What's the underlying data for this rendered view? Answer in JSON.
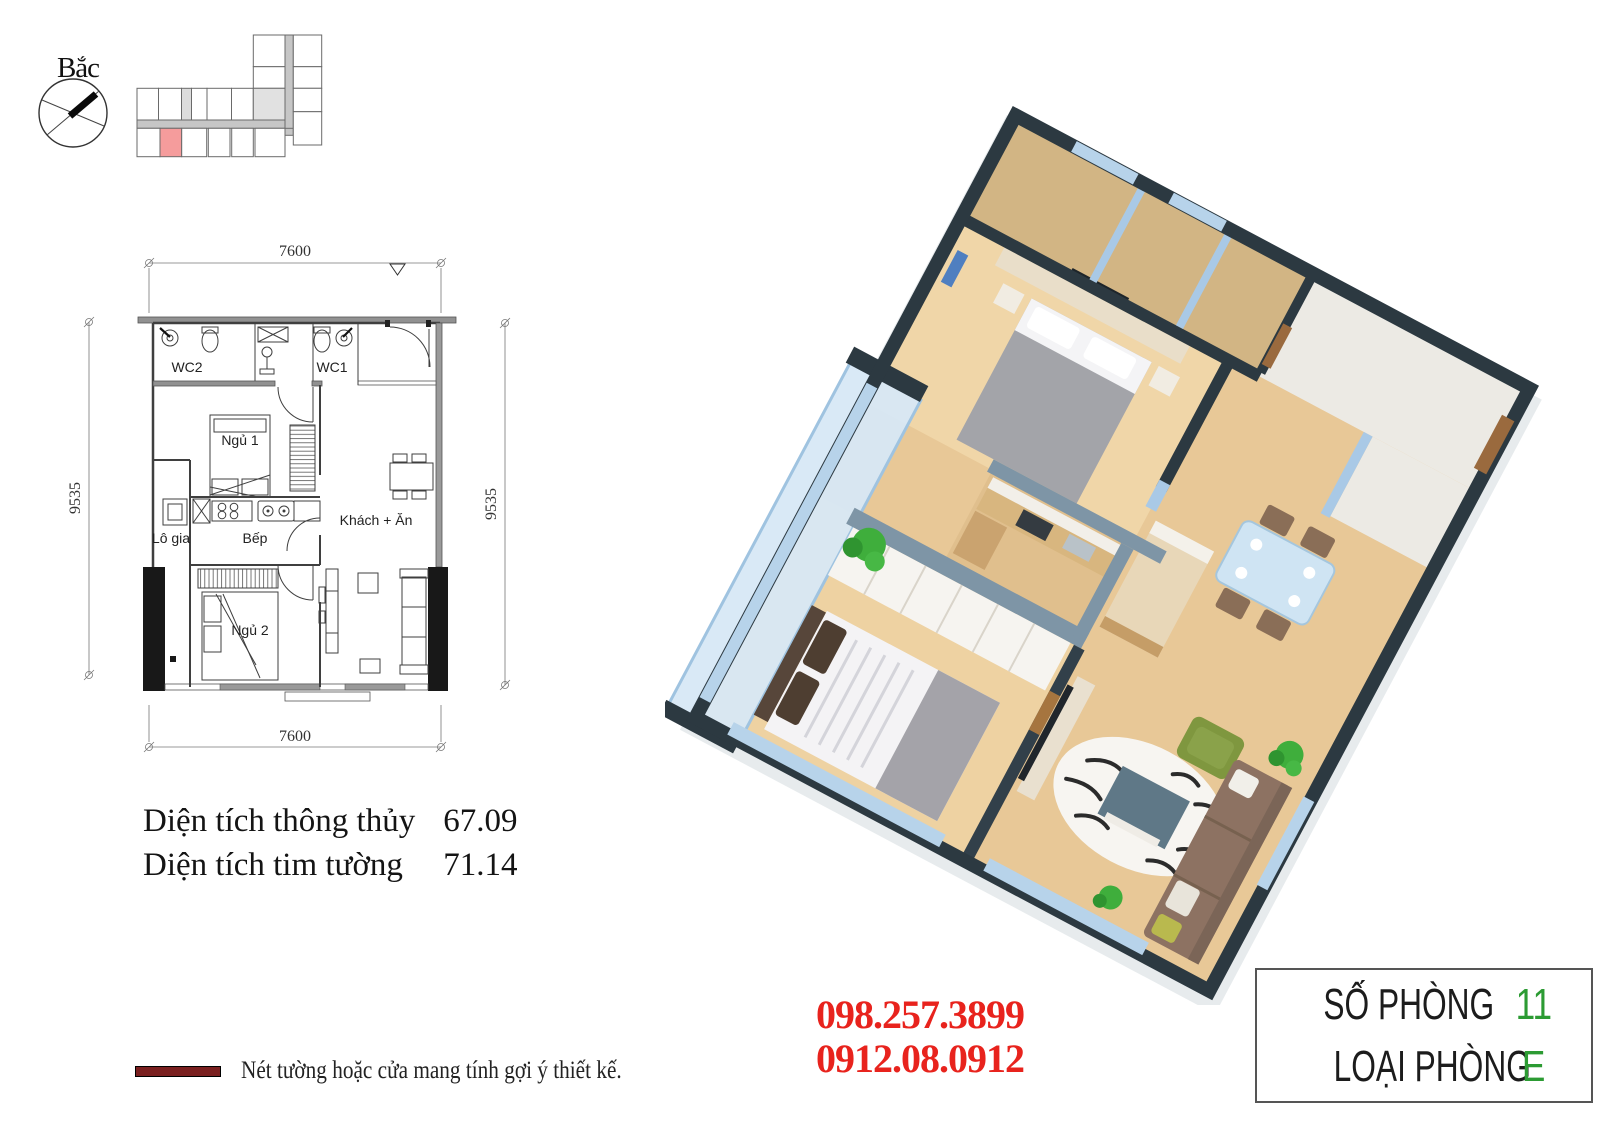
{
  "compass": {
    "label": "Bắc"
  },
  "keyplan": {
    "highlight_color": "#f59c9c",
    "neighbor_color": "#e1e1e1",
    "corridor_color": "#c6c6c6"
  },
  "floorplan": {
    "dims": {
      "top": "7600",
      "bottom": "7600",
      "left": "9535",
      "right": "9535"
    },
    "rooms": {
      "wc2": "WC2",
      "wc1": "WC1",
      "bedroom1": "Ngủ 1",
      "bedroom2": "Ngủ 2",
      "kitchen": "Bếp",
      "loggia": "Lô gia",
      "living": "Khách + Ăn"
    }
  },
  "areas": {
    "clear_label": "Diện tích thông thủy",
    "clear_value": "67.09",
    "wall_label": "Diện tích tim tường",
    "wall_value": "71.14"
  },
  "legend": {
    "note": "Nét tường hoặc cửa mang tính gợi ý thiết kế.",
    "line_color": "#7a1f1f"
  },
  "contact": {
    "phone1": "098.257.3899",
    "phone2": "0912.08.0912",
    "color": "#e8231d"
  },
  "room_info": {
    "number_label": "SỐ PHÒNG",
    "number_value": "11",
    "type_label": "LOẠI PHÒNG",
    "type_value": "E",
    "value_color": "#2c9b33"
  }
}
